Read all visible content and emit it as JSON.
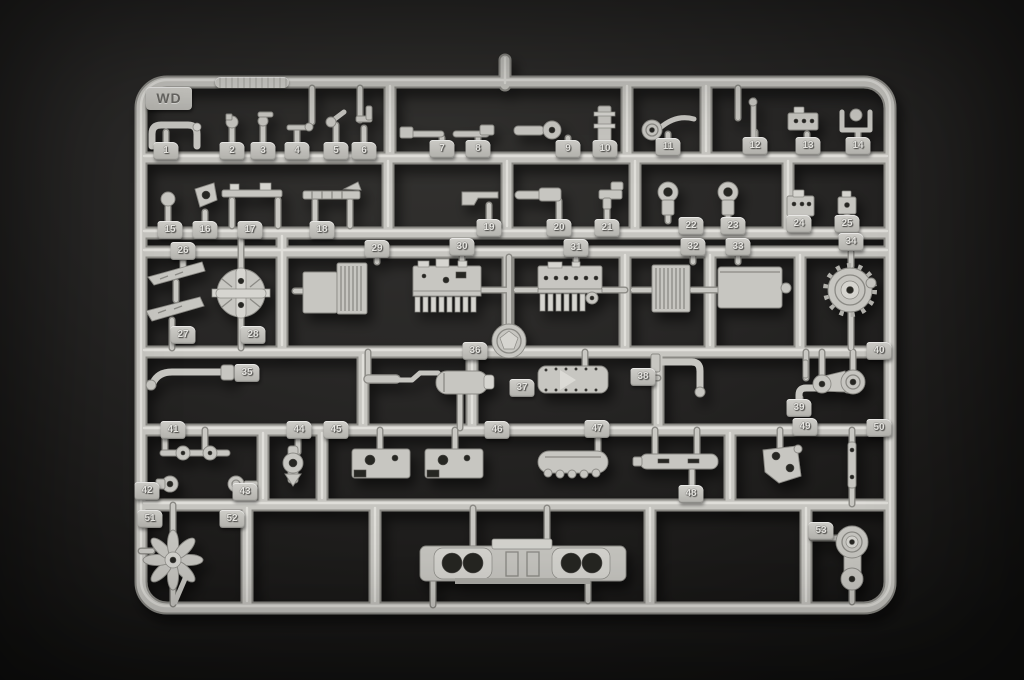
{
  "colors": {
    "background": "#232221",
    "plastic": "#c7c6c1",
    "plastic_dark": "#8b8a85",
    "plastic_light": "#e3e2dd",
    "tag_plate": "#bdbcb7",
    "digit": "#e6e5e1"
  },
  "sprue": {
    "gate_label": "WD",
    "part_tags": [
      {
        "n": "1",
        "x": 166,
        "y": 151
      },
      {
        "n": "2",
        "x": 232,
        "y": 151
      },
      {
        "n": "3",
        "x": 263,
        "y": 151
      },
      {
        "n": "4",
        "x": 297,
        "y": 151
      },
      {
        "n": "5",
        "x": 336,
        "y": 151
      },
      {
        "n": "6",
        "x": 364,
        "y": 151
      },
      {
        "n": "7",
        "x": 442,
        "y": 149
      },
      {
        "n": "8",
        "x": 478,
        "y": 149
      },
      {
        "n": "9",
        "x": 568,
        "y": 149
      },
      {
        "n": "10",
        "x": 605,
        "y": 149
      },
      {
        "n": "11",
        "x": 668,
        "y": 147
      },
      {
        "n": "12",
        "x": 755,
        "y": 146
      },
      {
        "n": "13",
        "x": 808,
        "y": 146
      },
      {
        "n": "14",
        "x": 858,
        "y": 146
      },
      {
        "n": "15",
        "x": 170,
        "y": 230
      },
      {
        "n": "16",
        "x": 205,
        "y": 230
      },
      {
        "n": "17",
        "x": 250,
        "y": 230
      },
      {
        "n": "18",
        "x": 322,
        "y": 230
      },
      {
        "n": "19",
        "x": 489,
        "y": 228
      },
      {
        "n": "20",
        "x": 559,
        "y": 228
      },
      {
        "n": "21",
        "x": 607,
        "y": 228
      },
      {
        "n": "22",
        "x": 691,
        "y": 226
      },
      {
        "n": "23",
        "x": 733,
        "y": 226
      },
      {
        "n": "24",
        "x": 799,
        "y": 224
      },
      {
        "n": "25",
        "x": 847,
        "y": 224
      },
      {
        "n": "26",
        "x": 183,
        "y": 251
      },
      {
        "n": "27",
        "x": 183,
        "y": 335
      },
      {
        "n": "28",
        "x": 253,
        "y": 335
      },
      {
        "n": "29",
        "x": 377,
        "y": 249
      },
      {
        "n": "30",
        "x": 462,
        "y": 247
      },
      {
        "n": "31",
        "x": 576,
        "y": 248
      },
      {
        "n": "32",
        "x": 693,
        "y": 247
      },
      {
        "n": "33",
        "x": 738,
        "y": 247
      },
      {
        "n": "34",
        "x": 851,
        "y": 242
      },
      {
        "n": "35",
        "x": 247,
        "y": 373
      },
      {
        "n": "36",
        "x": 475,
        "y": 351
      },
      {
        "n": "37",
        "x": 522,
        "y": 388
      },
      {
        "n": "38",
        "x": 643,
        "y": 377
      },
      {
        "n": "39",
        "x": 799,
        "y": 408
      },
      {
        "n": "40",
        "x": 879,
        "y": 351
      },
      {
        "n": "41",
        "x": 173,
        "y": 430
      },
      {
        "n": "42",
        "x": 147,
        "y": 491
      },
      {
        "n": "43",
        "x": 245,
        "y": 492
      },
      {
        "n": "44",
        "x": 299,
        "y": 430
      },
      {
        "n": "45",
        "x": 336,
        "y": 430
      },
      {
        "n": "46",
        "x": 497,
        "y": 430
      },
      {
        "n": "47",
        "x": 597,
        "y": 429
      },
      {
        "n": "48",
        "x": 691,
        "y": 494
      },
      {
        "n": "49",
        "x": 805,
        "y": 427
      },
      {
        "n": "50",
        "x": 879,
        "y": 428
      },
      {
        "n": "51",
        "x": 150,
        "y": 519
      },
      {
        "n": "52",
        "x": 232,
        "y": 519
      },
      {
        "n": "53",
        "x": 821,
        "y": 531
      }
    ]
  }
}
